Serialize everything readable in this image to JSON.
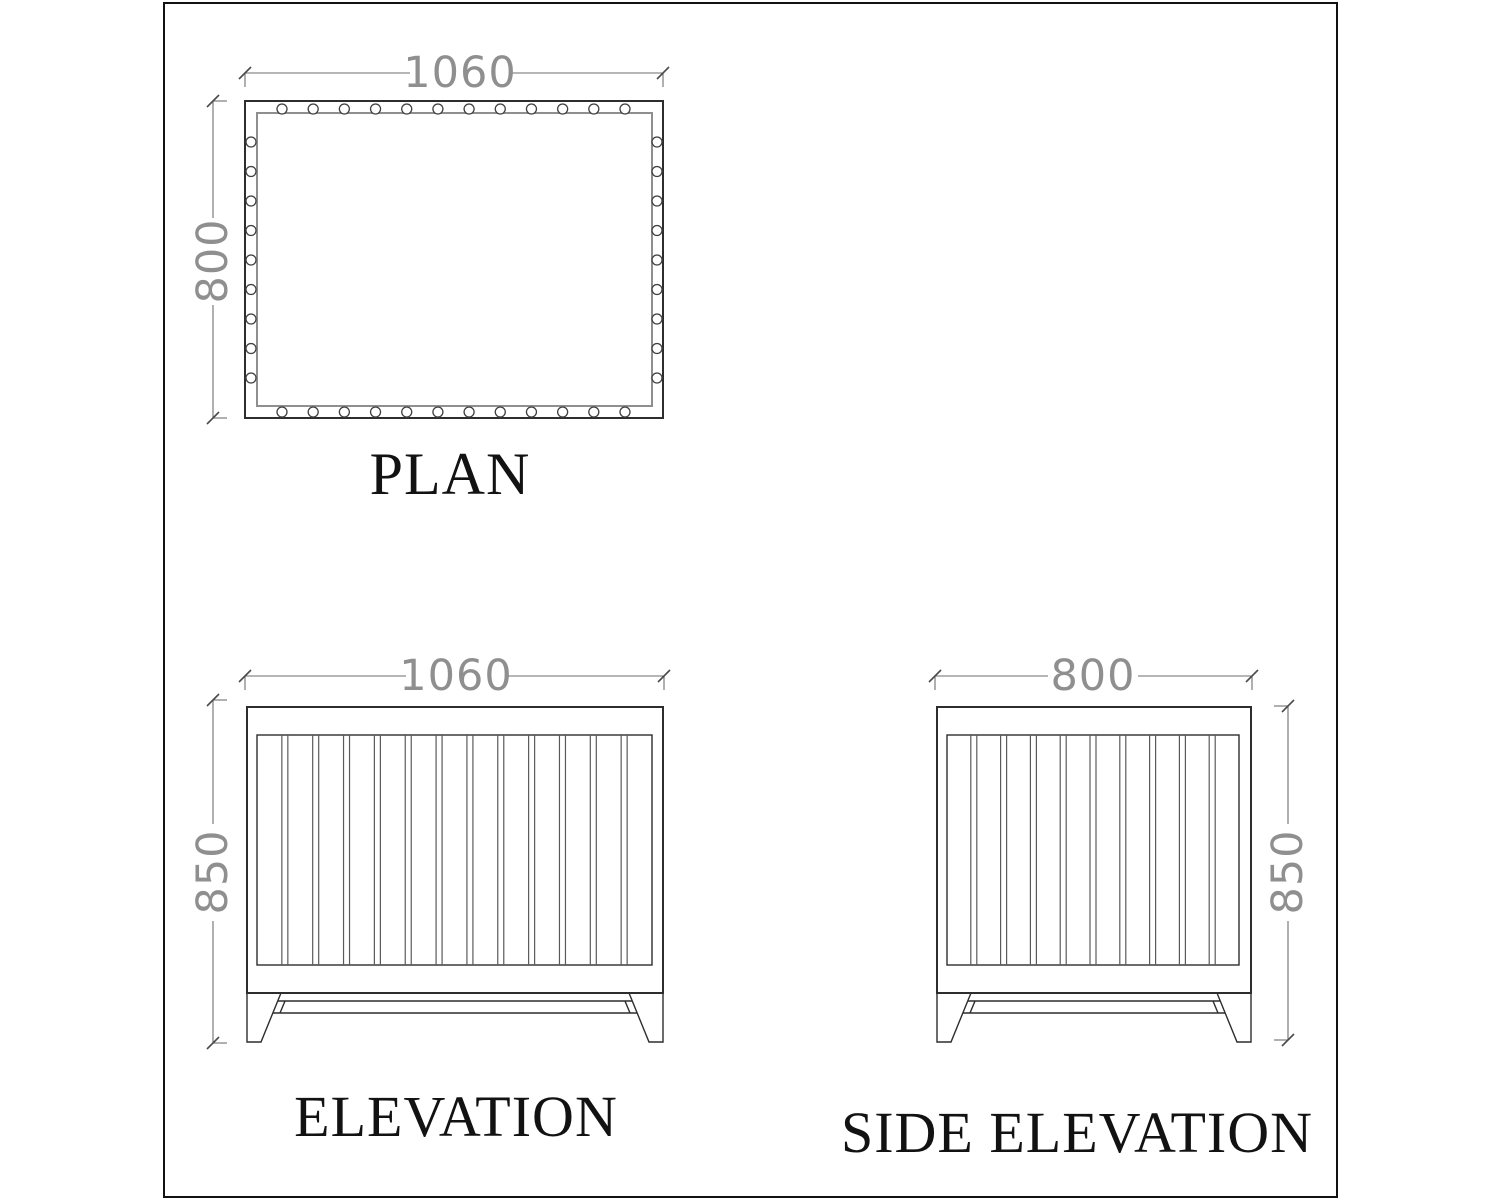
{
  "drawing": {
    "views": {
      "plan": {
        "label": "PLAN",
        "dim_width": "1060",
        "dim_height": "800",
        "fasteners": {
          "top": 12,
          "bottom": 12,
          "left": 9,
          "right": 9
        }
      },
      "elevation": {
        "label": "ELEVATION",
        "dim_width": "1060",
        "dim_height": "850",
        "slat_count": 13
      },
      "side_elevation": {
        "label": "SIDE ELEVATION",
        "dim_width": "800",
        "dim_height": "850",
        "slat_count": 10
      }
    },
    "colors": {
      "object_line": "#2d2d2d",
      "secondary_line": "#8f8f8f",
      "dimension_line": "#6e6e6e",
      "dimension_text": "#8f8f8f",
      "label_text": "#121212",
      "background": "#ffffff"
    }
  }
}
